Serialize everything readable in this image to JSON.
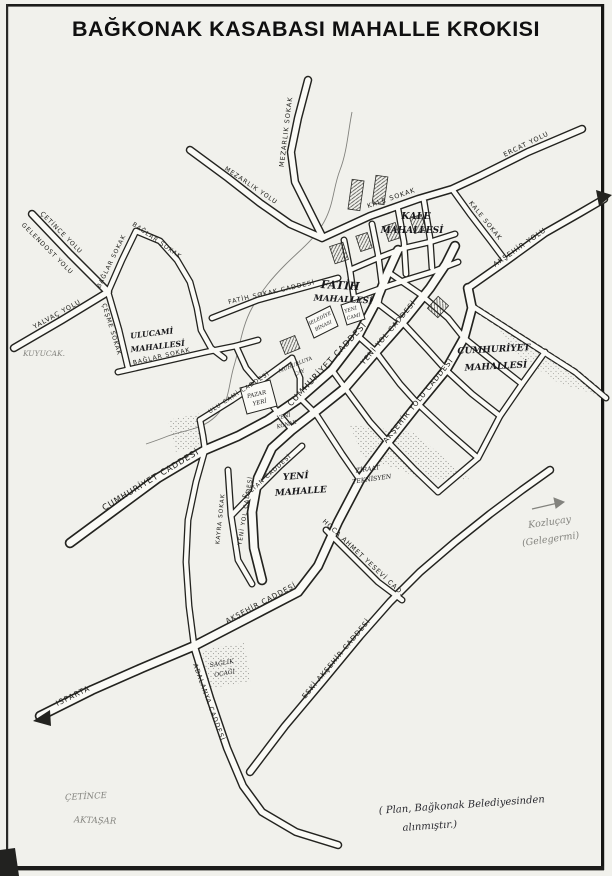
{
  "page": {
    "title": "BAĞKONAK KASABASI MAHALLE KROKISI",
    "source_note_line1": "( Plan, Bağkonak Belediyesinden",
    "source_note_line2": "alınmıştır.)"
  },
  "neighborhoods": {
    "kale": {
      "line1": "KALE",
      "line2": "MAHALLESİ"
    },
    "fatih": {
      "line1": "FATİH",
      "line2": "MAHALLESİ"
    },
    "ulucami": {
      "line1": "ULUCAMİ",
      "line2": "MAHALLESİ"
    },
    "cumhuriyet": {
      "line1": "CUMHURİYET",
      "line2": "MAHALLESİ"
    },
    "yeni": {
      "line1": "YENİ",
      "line2": "MAHALLE"
    }
  },
  "streets": {
    "cumhuriyet_cad": "CUMHURİYET CADDESİ",
    "yeniyol_cad": "YENİ YOL CADDESİ",
    "aksehir_yolu_cad": "AKŞEHİR YOLU CADDESİ",
    "aksehir_yolu": "AKŞEHİR YOLU",
    "aksehir_cad": "AKŞEHİR CADDESİ",
    "eski_aksehir_cad": "ESKİ AKŞEHİR CADDESİ",
    "hoca_ahmet_yesevi": "HOCA AHMET YESEVİ CAD.",
    "adalanya_cad": "ADALANYA CADDESİ",
    "kale_sokak": "KALE SOKAK",
    "ercat_yolu": "ERCAT YOLU",
    "mezarlik_sokak": "MEZARLIK SOKAK",
    "mezarlik_yolu": "MEZARLIK YOLU",
    "baglar_sokak": "BAĞLAR SOKAK",
    "cesme_sokak": "ÇEŞME SOKAK",
    "fatih_sokak": "FATİH SOKAK CADDESİ",
    "ulucami_cad": "ULU CAMİ CADDESİ",
    "sultan_cad": "SULTAN CADDESİ",
    "kayra_sokak": "KAYRA SOKAK",
    "yalvac_yolu": "YALVAÇ YOLU",
    "cetince_yolu": "ÇETİNCE YOLU",
    "gelendost_yolu": "GELENDOST YOLU",
    "isparta": "ISPARTA"
  },
  "places": {
    "pazar": {
      "line1": "PAZAR",
      "line2": "YERİ"
    },
    "belediye": {
      "line1": "BELEDİYE",
      "line2": "BİNASI"
    },
    "yenicami": {
      "line1": "YENİ",
      "line2": "CAMİ"
    },
    "ziraat": {
      "line1": "ZİRAAT",
      "line2": "TEKNİSYEN"
    },
    "saglik": {
      "line1": "SAĞLIK",
      "line2": "OCAĞI"
    },
    "cay": {
      "line1": "MUHURLUYA",
      "line2": "ÇAY"
    },
    "konak": {
      "line1": "YENİ",
      "line2": "KONAK"
    }
  },
  "annotations": {
    "kuyucak": "KUYUCAK.",
    "cetince": "ÇETİNCE",
    "aktasar": "AKTAŞAR",
    "kozlucay": "Kozluçay",
    "kozlucay_old": "(Gelegermi)"
  }
}
